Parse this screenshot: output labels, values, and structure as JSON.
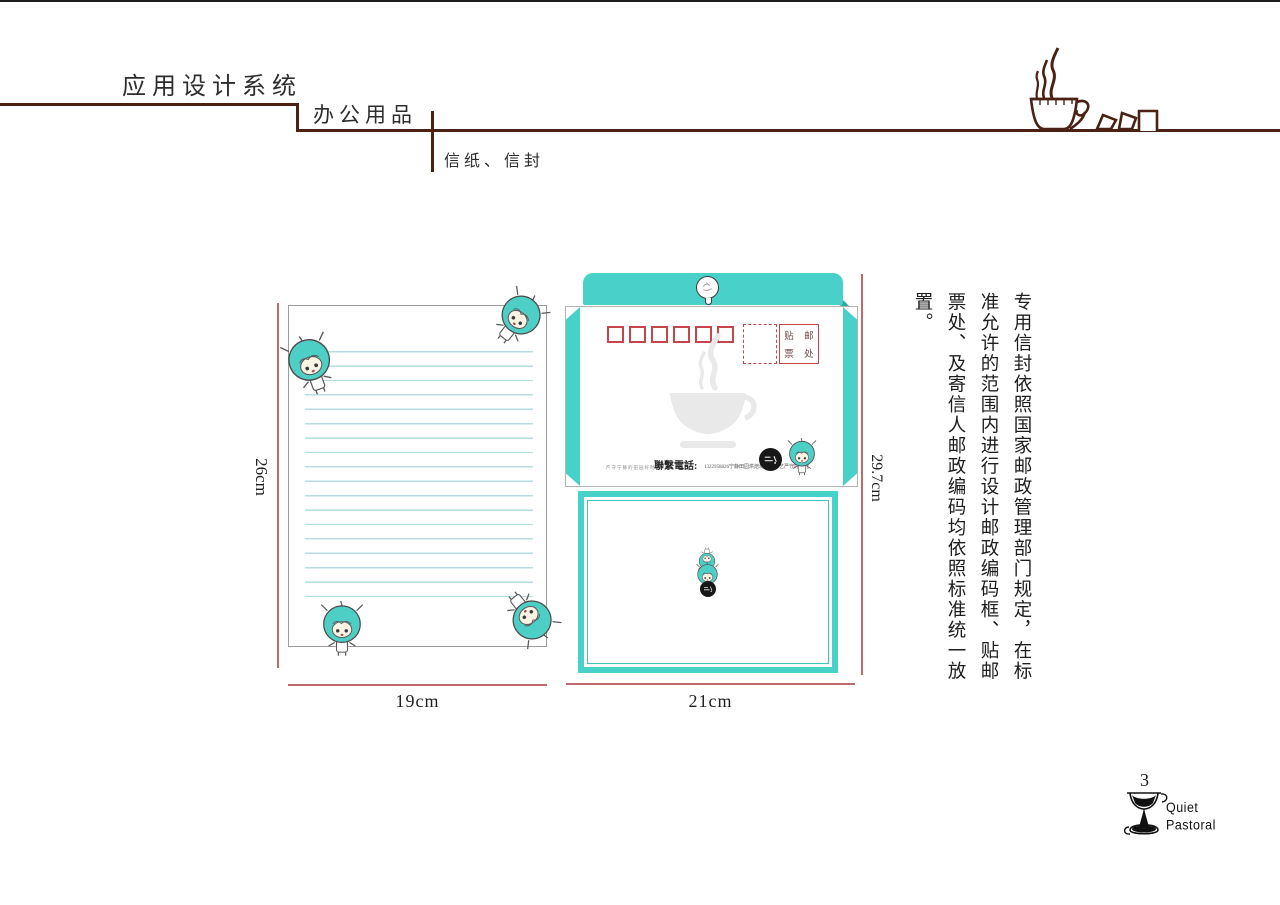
{
  "header": {
    "title": "应用设计系统",
    "category": "办公用品",
    "subcategory": "信纸、信封"
  },
  "letterhead": {
    "height_label": "26cm",
    "width_label": "19cm"
  },
  "envelope": {
    "height_label": "29.7cm",
    "width_label": "21cm",
    "stamp_line1": "贴 邮",
    "stamp_line2": "票 处",
    "left_note": "严守宁静的田园好时光",
    "phone_label": "聯繫電話:",
    "phone_detail": "1322958826宁静田园烘焙坊出品工艺严守好时光"
  },
  "description": {
    "text": "专用信封依照国家邮政管理部门规定，在标准允许的范围内进行设计邮政编码框、贴邮票处、及寄信人邮政编码均依照标准统一放置。"
  },
  "footer": {
    "page_number": "3",
    "brand_line1": "Quiet",
    "brand_line2": "Pastoral"
  },
  "colors": {
    "teal": "#47d1c9",
    "teal_dark": "#2ba89f",
    "line_brown": "#4a2113",
    "dimension_red": "#c0696d",
    "postal_red": "#c4464a",
    "ruled_line_blue": "#b5dde2"
  }
}
